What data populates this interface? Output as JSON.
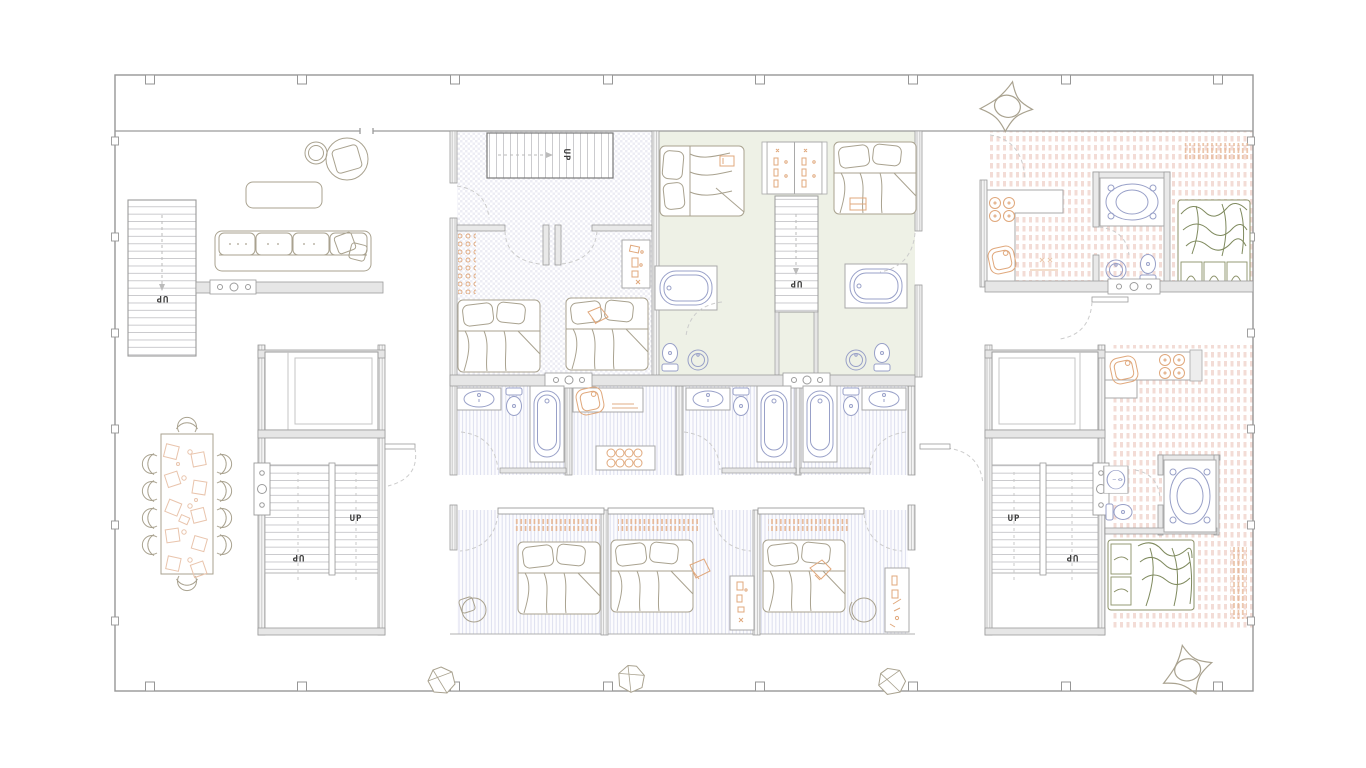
{
  "plan": {
    "type": "residential floor plan - upper level",
    "stair_labels": [
      {
        "id": "lobby-long-stair",
        "label": "UP",
        "orientation": "rotated-180"
      },
      {
        "id": "unit-a-stair",
        "label": "UP",
        "orientation": "rotated-90"
      },
      {
        "id": "center-stair",
        "label": "UP",
        "orientation": "rotated-180"
      },
      {
        "id": "west-core-stair-right-run",
        "label": "UP",
        "orientation": "normal"
      },
      {
        "id": "west-core-stair-left-run",
        "label": "UP",
        "orientation": "rotated-180"
      },
      {
        "id": "east-core-stair-left-run",
        "label": "UP",
        "orientation": "normal"
      },
      {
        "id": "east-core-stair-right-run",
        "label": "UP",
        "orientation": "rotated-180"
      }
    ],
    "colors": {
      "wall_gray": "#9b9b9b",
      "furniture_outline": "#a9a28f",
      "bedding_green": "#7f8a5e",
      "plumbing_purple": "#98a0c8",
      "accent_orange": "#e0a87c",
      "floor_checker_lavender": "#ededf4",
      "floor_green_tint": "#eef1e6",
      "floor_pink_dash": "#f3dcd6",
      "floor_stripe_lavender": "#dcdeee"
    },
    "inventory": {
      "staircases": 5,
      "beds": 9,
      "bathtubs": 5,
      "spa_tubs": 2,
      "toilets": 8,
      "sinks": 10,
      "dining_seats": 10,
      "sofas": 1,
      "site_rocks": 5
    }
  }
}
